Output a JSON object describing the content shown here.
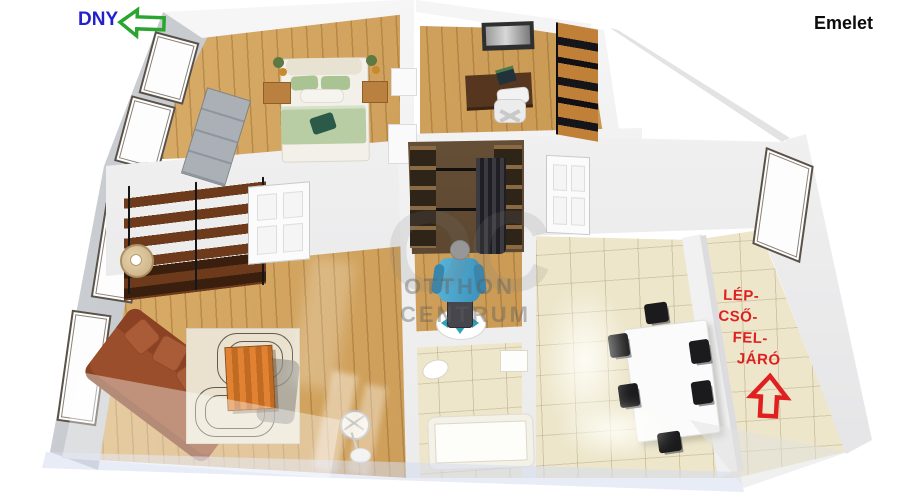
{
  "header": {
    "compass_label": "DNY",
    "floor_label": "Emelet"
  },
  "stairs_note": {
    "lines": [
      "LÉP-",
      "CSŐ-",
      "FEL-",
      "JÁRÓ"
    ]
  },
  "watermark": {
    "initials": "OC",
    "name_line1": "OTTHON",
    "name_line2": "CENTRUM"
  },
  "icons": {
    "compass_arrow": "left-arrow-outline",
    "stairs_arrow": "up-arrow-outline"
  },
  "colors": {
    "compass_text": "#2121cf",
    "compass_arrow": "#2aa52f",
    "floor_label_text": "#0c0c0c",
    "stairs_text": "#e02020",
    "wood_floor": "#cf9c50",
    "tile_floor": "#ede6ca",
    "interior_wall": "#f2f2f2",
    "exterior_wall": "#bdc0c4",
    "sofa": "#9a4e2b",
    "coffee_table": "#d2742b",
    "bed_duvet": "#b9cda4",
    "person_shirt": "#49a8cf"
  }
}
